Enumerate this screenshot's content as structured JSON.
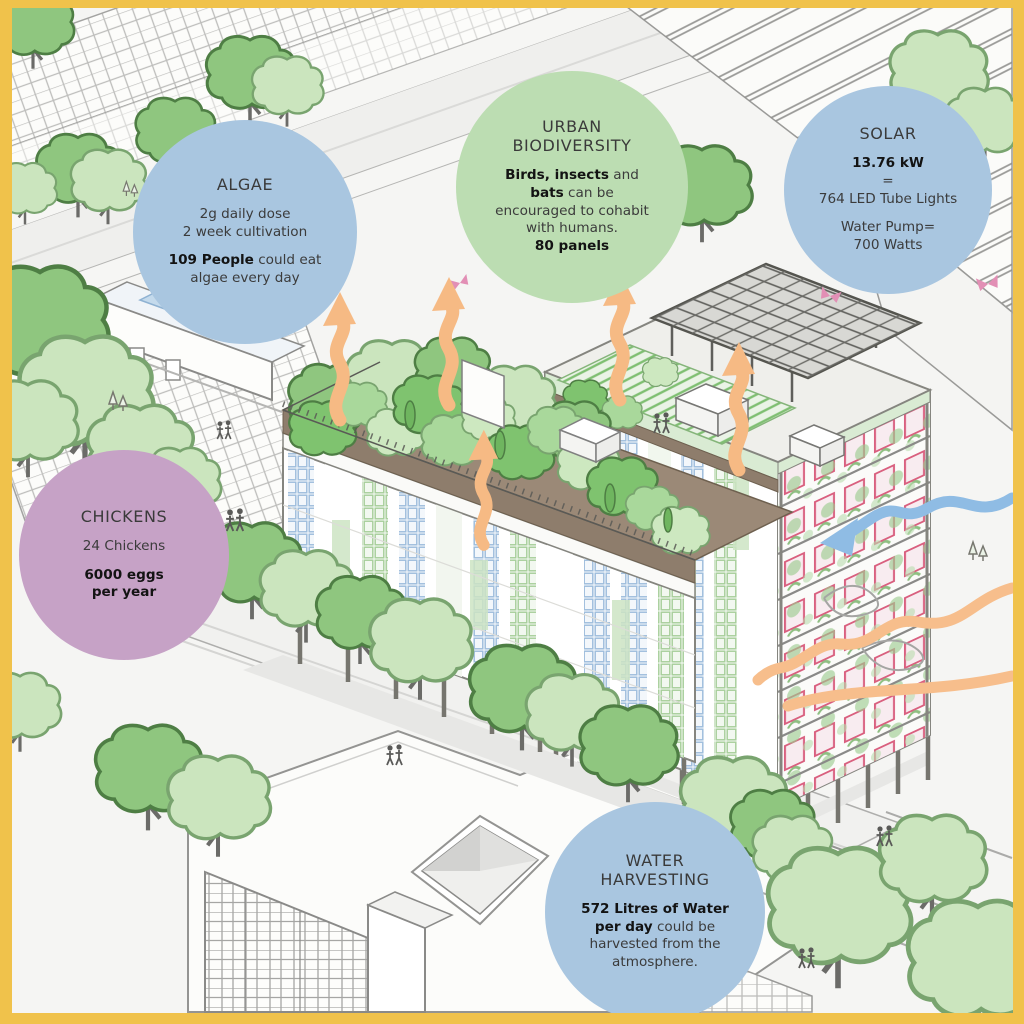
{
  "frame": {
    "border_color": "#F0C24B"
  },
  "bubbles": {
    "algae": {
      "color": "#A9C6E0",
      "title": "ALGAE",
      "line1": "2g daily dose",
      "line2": "2 week cultivation",
      "line3_bold": "109 People",
      "line3_rest": " could eat",
      "line4": "algae every day"
    },
    "biodiversity": {
      "color": "#BCDDB2",
      "title_line1": "URBAN",
      "title_line2": "BIODIVERSITY",
      "line1_bold": "Birds, insects",
      "line1_rest": " and",
      "line2_bold": "bats",
      "line2_rest": " can be",
      "line3": "encouraged to cohabit",
      "line4": "with humans.",
      "line5_bold": "80 panels"
    },
    "solar": {
      "color": "#A9C6E0",
      "title": "SOLAR",
      "line1_bold": "13.76 kW",
      "line2": "=",
      "line3": "764 LED Tube Lights",
      "line4": "Water Pump=",
      "line5": "700 Watts"
    },
    "chickens": {
      "color": "#C6A2C6",
      "title": "CHICKENS",
      "line1": "24 Chickens",
      "line2_bold": "6000 eggs",
      "line3_bold": "per year"
    },
    "water": {
      "color": "#A9C6E0",
      "title_line1": "WATER",
      "title_line2": "HARVESTING",
      "line1_bold": "572 Litres of Water",
      "line2_bold": "per day",
      "line2_rest": " could be",
      "line3": "harvested from the",
      "line4": "atmosphere."
    }
  },
  "scene": {
    "colors": {
      "background": "#F5F5F3",
      "tree_green": "#8FC67F",
      "tree_pale": "#CBE5BE",
      "roof_bush_bright": "#7FC36F",
      "soil_brown": "#8E7D6C",
      "arrow_orange": "#F6BA84",
      "water_blue": "#8FBCE4",
      "window_blue": "#9FBEDC",
      "window_green": "#A8CF9C",
      "window_pink": "#D9607F",
      "butterfly_pink": "#E28FB5"
    },
    "icon_legend": {
      "steam-arrow-icon": "orange wavy evaporation arrow",
      "water-arrow-icon": "blue wavy water flow arrow",
      "energy-flow-icon": "orange ground flow line",
      "tree-icon": "street tree blob",
      "pedestrians-icon": "pair of tiny people",
      "butterfly-icon": "pink butterfly",
      "solar-canopy-icon": "rooftop solar panel grid",
      "roof-garden-icon": "green roof with planting"
    }
  }
}
